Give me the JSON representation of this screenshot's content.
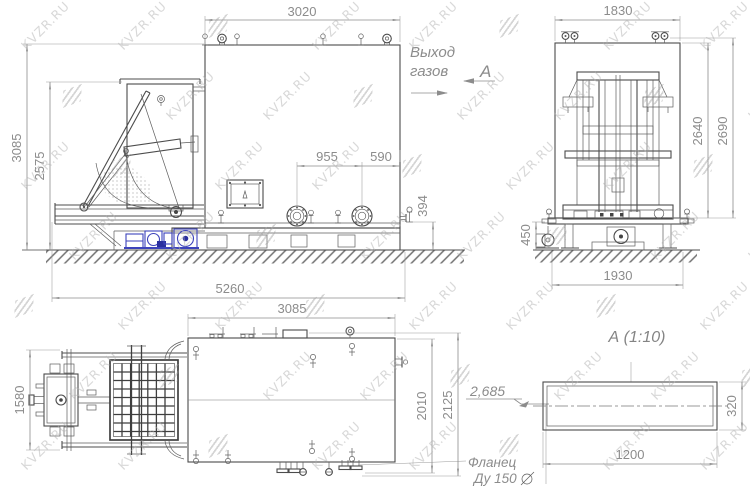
{
  "watermark": {
    "text": "KVZR.RU"
  },
  "views": {
    "front": {
      "dim_body_width": "3020",
      "dim_overall_height": "3085",
      "dim_hopper_height": "2575",
      "dim_flange_spacing": "955",
      "dim_flange_edge": "590",
      "dim_valve_height": "394",
      "dim_overall_length": "5260",
      "label_gas_outlet_line1": "Выход",
      "label_gas_outlet_line2": "газов",
      "label_section": "А"
    },
    "side": {
      "dim_width": "1830",
      "dim_frame_height": "2640",
      "dim_overall_height": "2690",
      "dim_foundation_height": "450",
      "dim_base_width": "1930"
    },
    "plan": {
      "dim_body_length": "3085",
      "dim_track_width": "1580",
      "dim_body_width": "2010",
      "dim_overall_width": "2125",
      "label_level": "2,685",
      "label_flange_line1": "Фланец",
      "label_flange_line2": "Ду 150"
    },
    "detail": {
      "title": "А  (1:10)",
      "dim_width": "1200",
      "dim_height": "320"
    }
  }
}
